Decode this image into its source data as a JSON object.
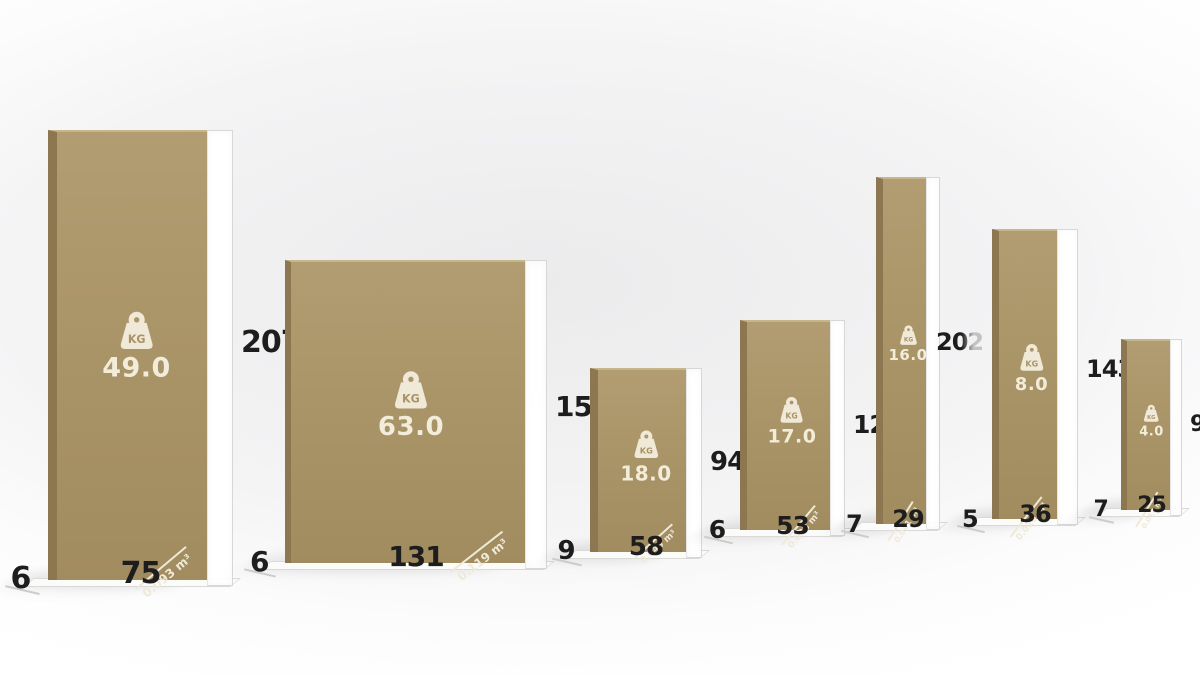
{
  "scene": {
    "kg_label": "KG",
    "colors": {
      "board_face": "#a99467",
      "board_edge": "#8c7751",
      "marking": "#f0e9d7",
      "dimension_text": "#1d1d1d",
      "background": "#f2f2f3"
    }
  },
  "panels": [
    {
      "weight": "49.0",
      "height": "207",
      "width": "75",
      "depth": "6",
      "volume": "0.093 m³"
    },
    {
      "weight": "63.0",
      "height": "152",
      "width": "131",
      "depth": "6",
      "volume": "0.119 m³"
    },
    {
      "weight": "18.0",
      "height": "94",
      "width": "58",
      "depth": "9",
      "volume": "0.049 m³"
    },
    {
      "weight": "17.0",
      "height": "121",
      "width": "53",
      "depth": "6",
      "volume": "0.038 m³"
    },
    {
      "weight": "16.0",
      "height": "202",
      "width": "29",
      "depth": "7",
      "volume": "0.041 m³"
    },
    {
      "weight": "8.0",
      "height": "143",
      "width": "36",
      "depth": "5",
      "volume": "0.026 m³"
    },
    {
      "weight": "4.0",
      "height": "97",
      "width": "25",
      "depth": "7",
      "volume": "0.017 m³"
    }
  ]
}
